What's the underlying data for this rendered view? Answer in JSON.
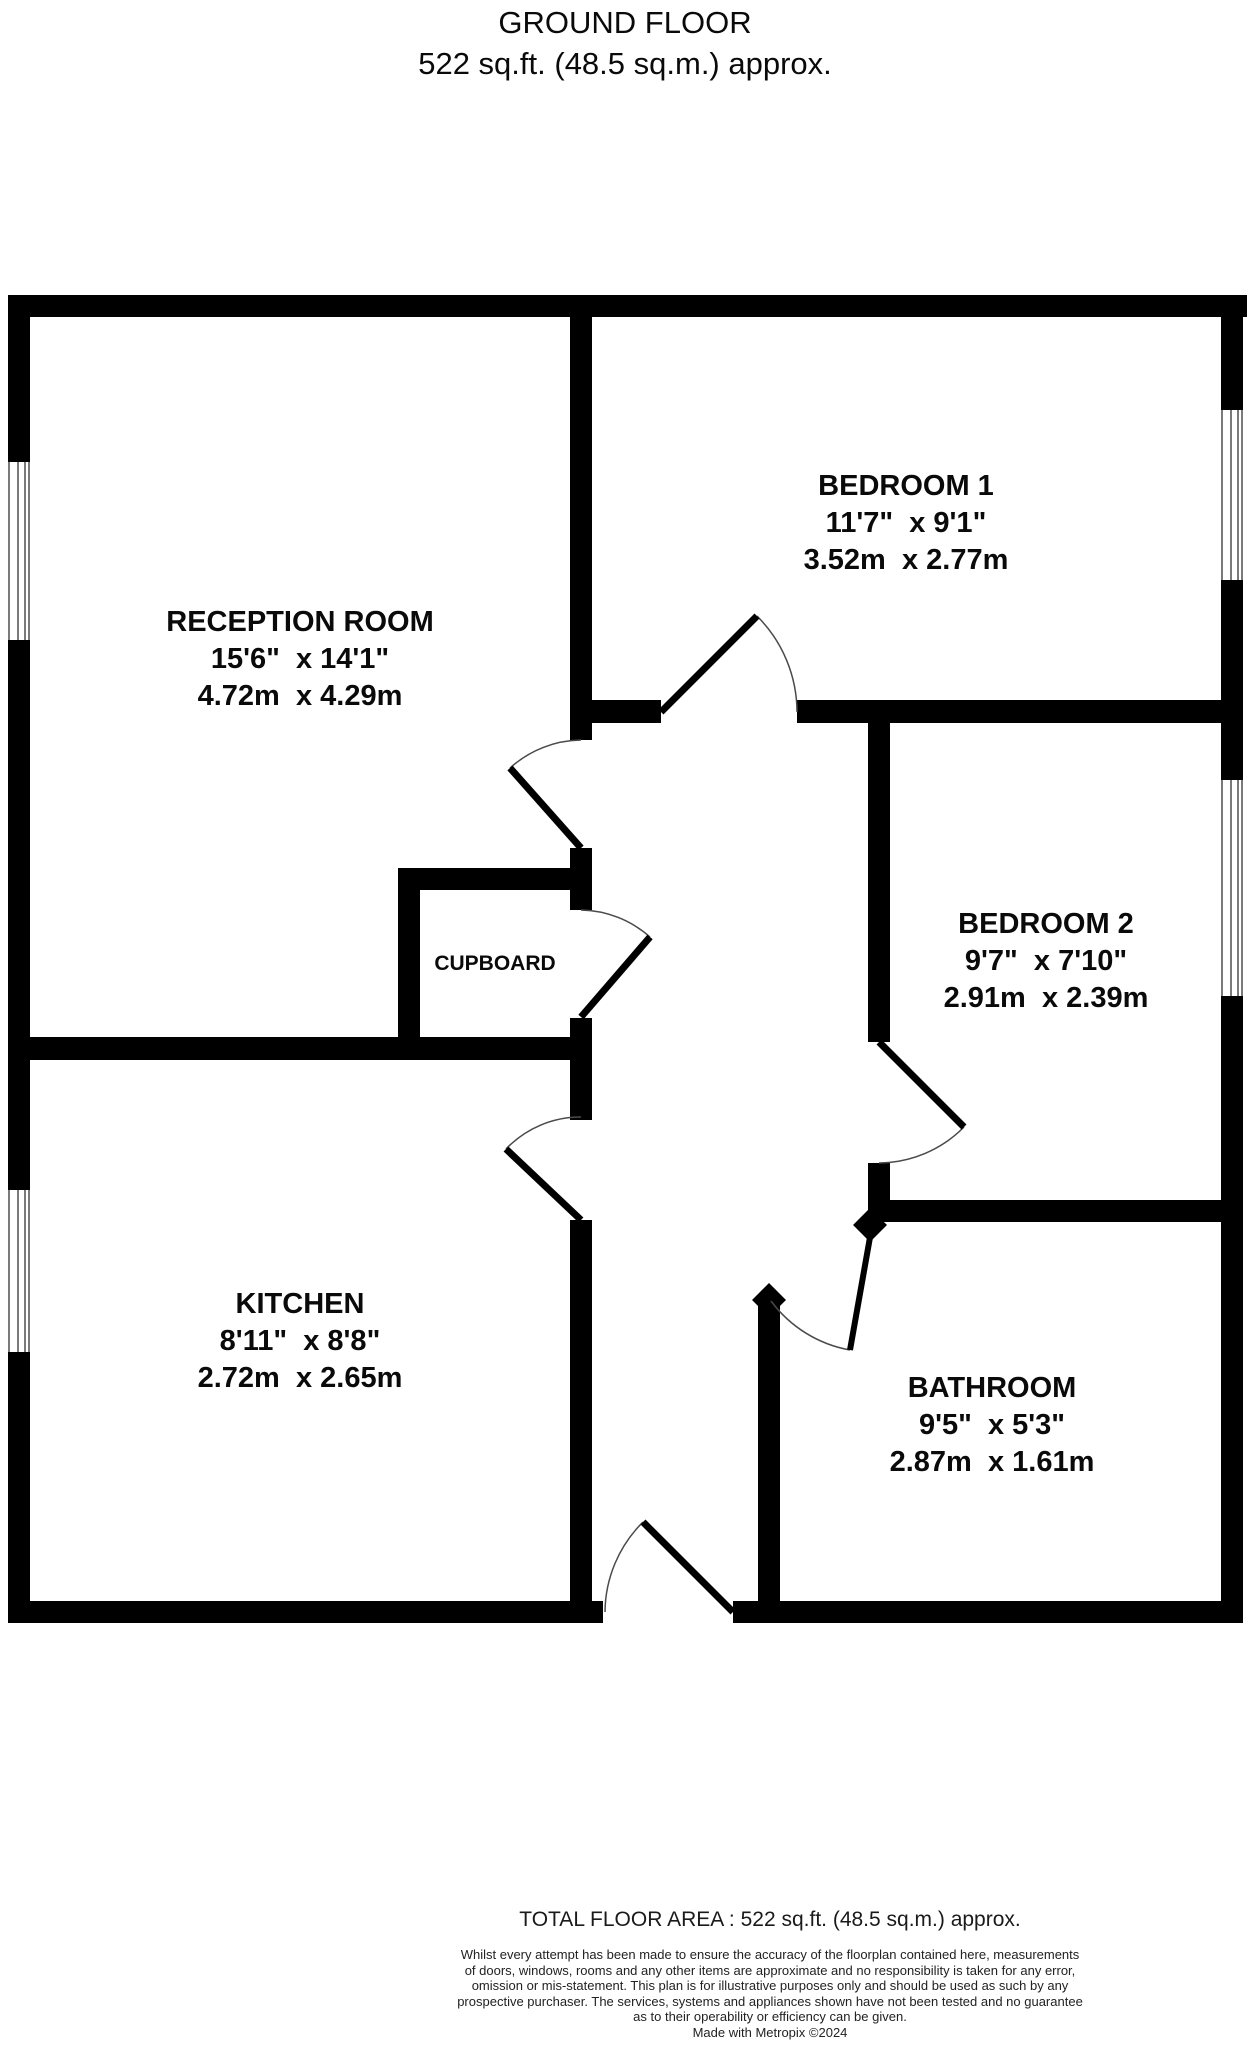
{
  "title": {
    "line1": "GROUND FLOOR",
    "line2": "522 sq.ft. (48.5 sq.m.) approx."
  },
  "rooms": {
    "reception": {
      "name": "RECEPTION ROOM",
      "imperial": "15'6\"  x 14'1\"",
      "metric": "4.72m  x 4.29m"
    },
    "bedroom1": {
      "name": "BEDROOM 1",
      "imperial": "11'7\"  x 9'1\"",
      "metric": "3.52m  x 2.77m"
    },
    "bedroom2": {
      "name": "BEDROOM 2",
      "imperial": "9'7\"  x 7'10\"",
      "metric": "2.91m  x 2.39m"
    },
    "kitchen": {
      "name": "KITCHEN",
      "imperial": "8'11\"  x 8'8\"",
      "metric": "2.72m  x 2.65m"
    },
    "bathroom": {
      "name": "BATHROOM",
      "imperial": "9'5\"  x 5'3\"",
      "metric": "2.87m  x 1.61m"
    },
    "cupboard": {
      "name": "CUPBOARD"
    }
  },
  "footer": {
    "total": "TOTAL FLOOR AREA : 522 sq.ft. (48.5 sq.m.) approx.",
    "disclaimer_lines": [
      "Whilst every attempt has been made to ensure the accuracy of the floorplan contained here, measurements",
      "of doors, windows, rooms and any other items are approximate and no responsibility is taken for any error,",
      "omission or mis-statement. This plan is for illustrative purposes only and should be used as such by any",
      "prospective purchaser. The services, systems and appliances shown have not been tested and no guarantee",
      "as to their operability or efficiency can be given."
    ],
    "made_with": "Made with Metropix ©2024"
  },
  "colors": {
    "wall": "#000000",
    "door_arc": "#4a4a4a",
    "window_line": "#7a7a7a"
  }
}
